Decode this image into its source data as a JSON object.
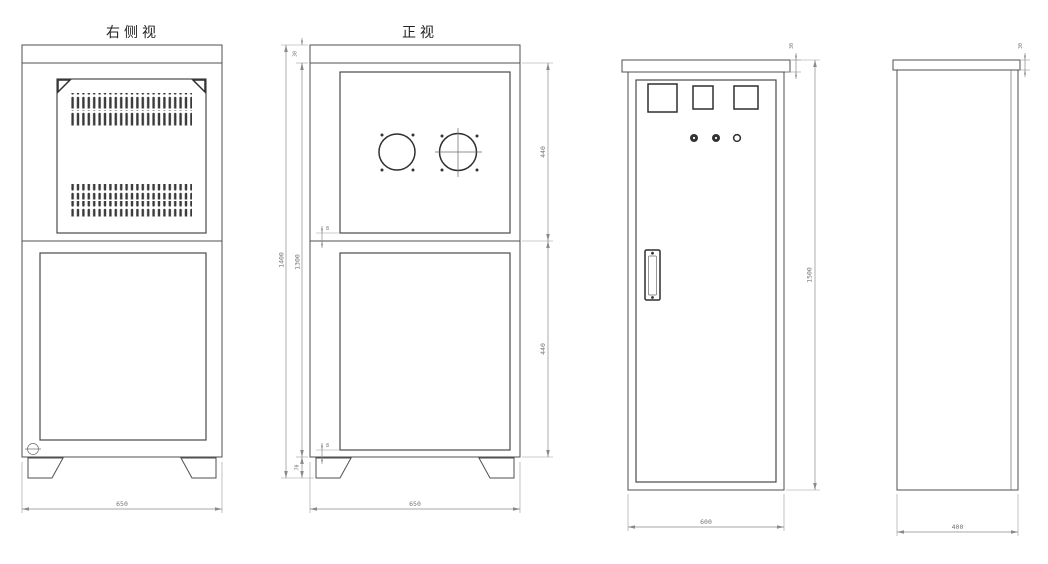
{
  "drawing_type": "cabinet-orthographic-views",
  "palette": {
    "background": "#ffffff",
    "object_line": "#4f4f4f",
    "bold_line": "#2f2f2f",
    "dimension_line": "#8a8a8a",
    "dimension_text": "#757575",
    "title_text": "#222222",
    "vent_fill": "#3a3a3a"
  },
  "views": {
    "side_right": {
      "title": "右侧视",
      "dim_width": "650"
    },
    "front": {
      "title": "正视",
      "dim_width": "650",
      "dim_overall_height": "1400",
      "dim_body_height": "1300",
      "dim_lid": "30",
      "dim_upper_panel": "440",
      "dim_lower_panel": "440",
      "dim_foot": "70",
      "dim_gap_top": "8",
      "dim_gap_bottom": "8"
    },
    "cabinet_front": {
      "dim_width": "600",
      "dim_height": "1500",
      "dim_lid": "30"
    },
    "cabinet_side": {
      "dim_width": "400",
      "dim_lid": "30"
    }
  }
}
